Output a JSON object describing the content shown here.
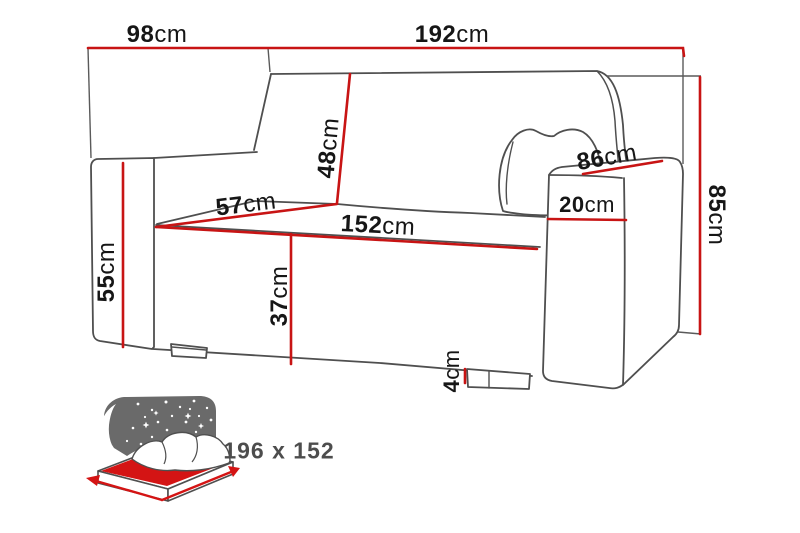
{
  "diagram": {
    "type": "sofa-bed dimension drawing",
    "dimensions": {
      "overall_depth": {
        "value": "98",
        "unit": "cm"
      },
      "overall_width": {
        "value": "192",
        "unit": "cm"
      },
      "overall_height": {
        "value": "85",
        "unit": "cm"
      },
      "backrest_height": {
        "value": "48",
        "unit": "cm"
      },
      "armrest_length": {
        "value": "86",
        "unit": "cm"
      },
      "seat_depth": {
        "value": "57",
        "unit": "cm"
      },
      "seat_width": {
        "value": "152",
        "unit": "cm"
      },
      "armrest_width": {
        "value": "20",
        "unit": "cm"
      },
      "armrest_height": {
        "value": "55",
        "unit": "cm"
      },
      "seat_height": {
        "value": "37",
        "unit": "cm"
      },
      "leg_height": {
        "value": "4",
        "unit": "cm"
      }
    }
  },
  "sleeping_area": {
    "size_label": "196 x 152",
    "icon": "sofa-bed-night-icon"
  },
  "colors": {
    "dimension_line": "#c81414",
    "drawing_outline": "#4f4f4f",
    "night_sky": "#6a6a6a",
    "mattress": "#d41414",
    "size_text": "#4d4d4d",
    "dimension_text": "#161616"
  }
}
